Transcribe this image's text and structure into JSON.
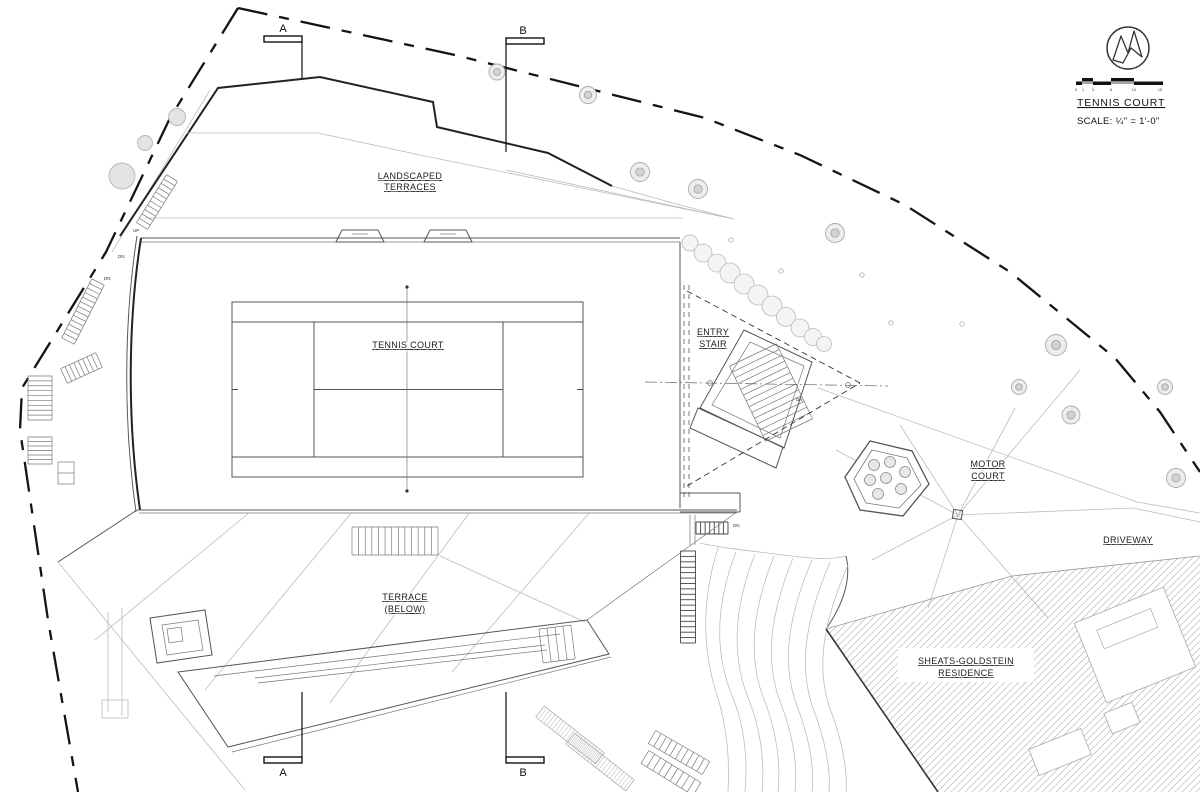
{
  "drawing": {
    "sheet_title": "TENNIS COURT",
    "scale_text": "SCALE: ¼\" = 1'-0\"",
    "scale_ticks": [
      "0",
      "1",
      "3",
      "6",
      "10",
      "15"
    ],
    "labels": {
      "landscaped_terraces_1": "LANDSCAPED",
      "landscaped_terraces_2": "TERRACES",
      "tennis_court": "TENNIS COURT",
      "entry_stair_1": "ENTRY",
      "entry_stair_2": "STAIR",
      "motor_court_1": "MOTOR",
      "motor_court_2": "COURT",
      "driveway": "DRIVEWAY",
      "terrace_below_1": "TERRACE",
      "terrace_below_2": "(BELOW)",
      "residence_1": "SHEATS-GOLDSTEIN",
      "residence_2": "RESIDENCE"
    },
    "section_markers": {
      "a": "A",
      "b": "B"
    },
    "annotations": {
      "dn": "DN",
      "up": "UP"
    },
    "colors": {
      "paper": "#ffffff",
      "line_dark": "#222222",
      "line_mid": "#555555",
      "line_light": "#bcbcbc",
      "tree_fill": "#e3e3e3",
      "boundary": "#141414"
    }
  }
}
